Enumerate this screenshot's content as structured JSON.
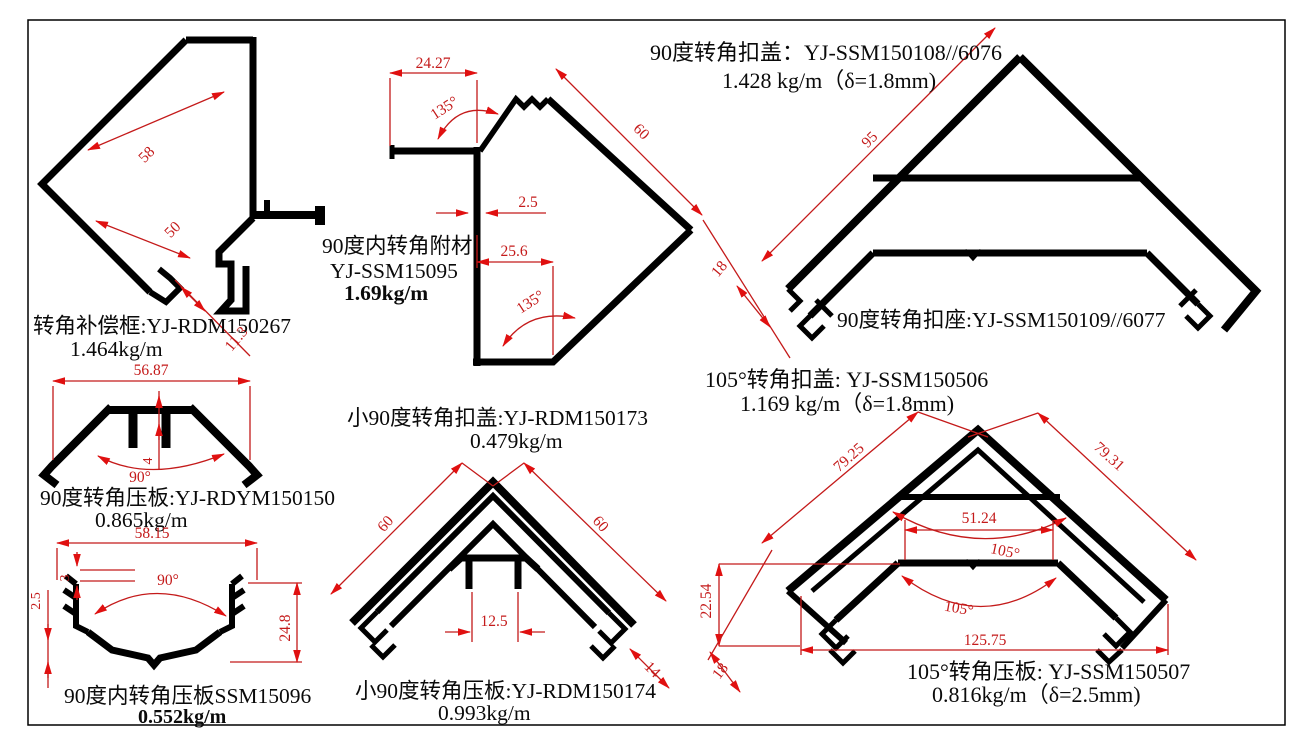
{
  "colors": {
    "profile_line": "#000000",
    "dimension_line": "#c41a1a",
    "background": "#ffffff"
  },
  "drawings": {
    "corner_comp": {
      "label": "转角补偿框:YJ-RDM150267",
      "weight": "1.464kg/m",
      "dims": {
        "width": "58",
        "inner": "50",
        "foot": "11.3"
      }
    },
    "attach90": {
      "label_line1": "90度内转角附材",
      "label_line2": "YJ-SSM15095",
      "weight": "1.69kg/m",
      "dims": {
        "top": "24.27",
        "angle_top": "135°",
        "side": "60",
        "web": "2.5",
        "bottom": "25.6",
        "angle_bottom": "135°"
      }
    },
    "cap90": {
      "title": "90度转角扣盖：YJ-SSM150108//6076",
      "weight": "1.428 kg/m（δ=1.8mm)",
      "seat_label": "90度转角扣座:YJ-SSM150109//6077",
      "dims": {
        "side": "95",
        "foot": "18"
      }
    },
    "press90": {
      "label": "90度转角压板:YJ-RDYM150150",
      "weight": "0.865kg/m",
      "dims": {
        "width": "56.87",
        "rib": "4",
        "angle": "90°"
      }
    },
    "inner_press90": {
      "label": "90度内转角压板SSM15096",
      "weight": "0.552kg/m",
      "dims": {
        "width": "58.15",
        "step": "3",
        "lip": "2.5",
        "angle": "90°",
        "height": "24.8"
      }
    },
    "small90": {
      "cap_label": "小90度转角扣盖:YJ-RDM150173",
      "cap_weight": "0.479kg/m",
      "press_label": "小90度转角压板:YJ-RDM150174",
      "press_weight": "0.993kg/m",
      "dims": {
        "side_left": "60",
        "side_right": "60",
        "slot": "12.5",
        "foot": "14"
      }
    },
    "deg105": {
      "cap_title": "105°转角扣盖: YJ-SSM150506",
      "cap_weight": "1.169 kg/m（δ=1.8mm)",
      "press_label": "105°转角压板: YJ-SSM150507",
      "press_weight": "0.816kg/m（δ=2.5mm)",
      "dims": {
        "side_left": "79.25",
        "side_right": "79.31",
        "inner_width": "51.24",
        "angle_top": "105°",
        "angle_bottom": "105°",
        "height": "22.54",
        "total_width": "125.75",
        "foot": "18"
      }
    }
  }
}
